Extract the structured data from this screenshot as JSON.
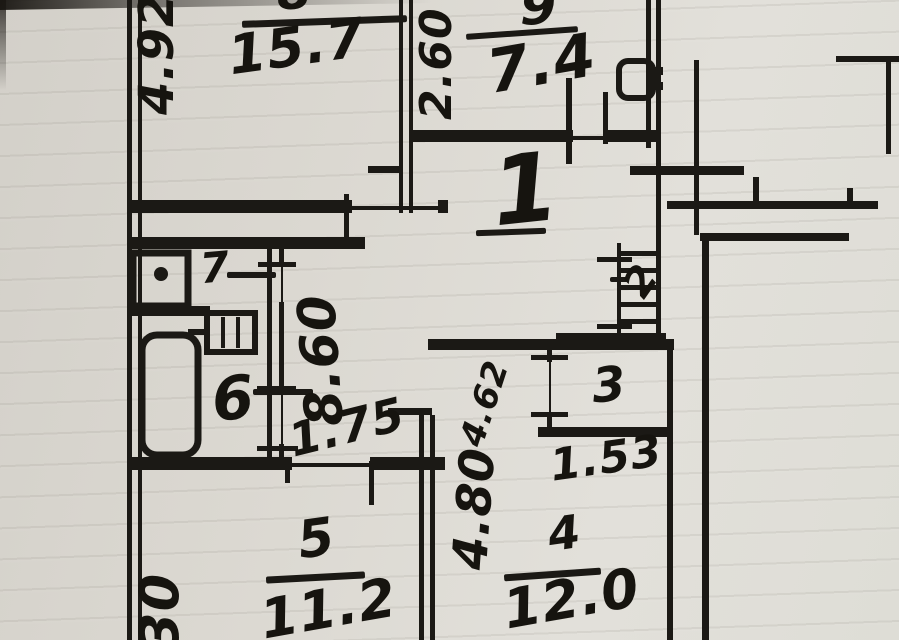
{
  "plan": {
    "hall": {
      "number": "1"
    },
    "rooms": {
      "r8": {
        "number": "8",
        "area": "15.7"
      },
      "r9": {
        "number": "9",
        "area": "7.4"
      },
      "r2": {
        "number": "2"
      },
      "r3": {
        "number": "3",
        "area": "1.53"
      },
      "r4": {
        "number": "4",
        "area": "12.0"
      },
      "r5": {
        "number": "5",
        "area": "11.2"
      },
      "r6": {
        "number": "6"
      },
      "r7": {
        "number": "7"
      }
    },
    "dimensions": {
      "left_top": "4.92",
      "kitchen_depth": "2.60",
      "corridor": "8.60",
      "passage": "1.75",
      "room4_upper": "4.62",
      "room4_side": "4.80",
      "bottom_left": "30"
    },
    "colors": {
      "ink": "#1b1915",
      "paper": "#dcd9d2"
    }
  }
}
